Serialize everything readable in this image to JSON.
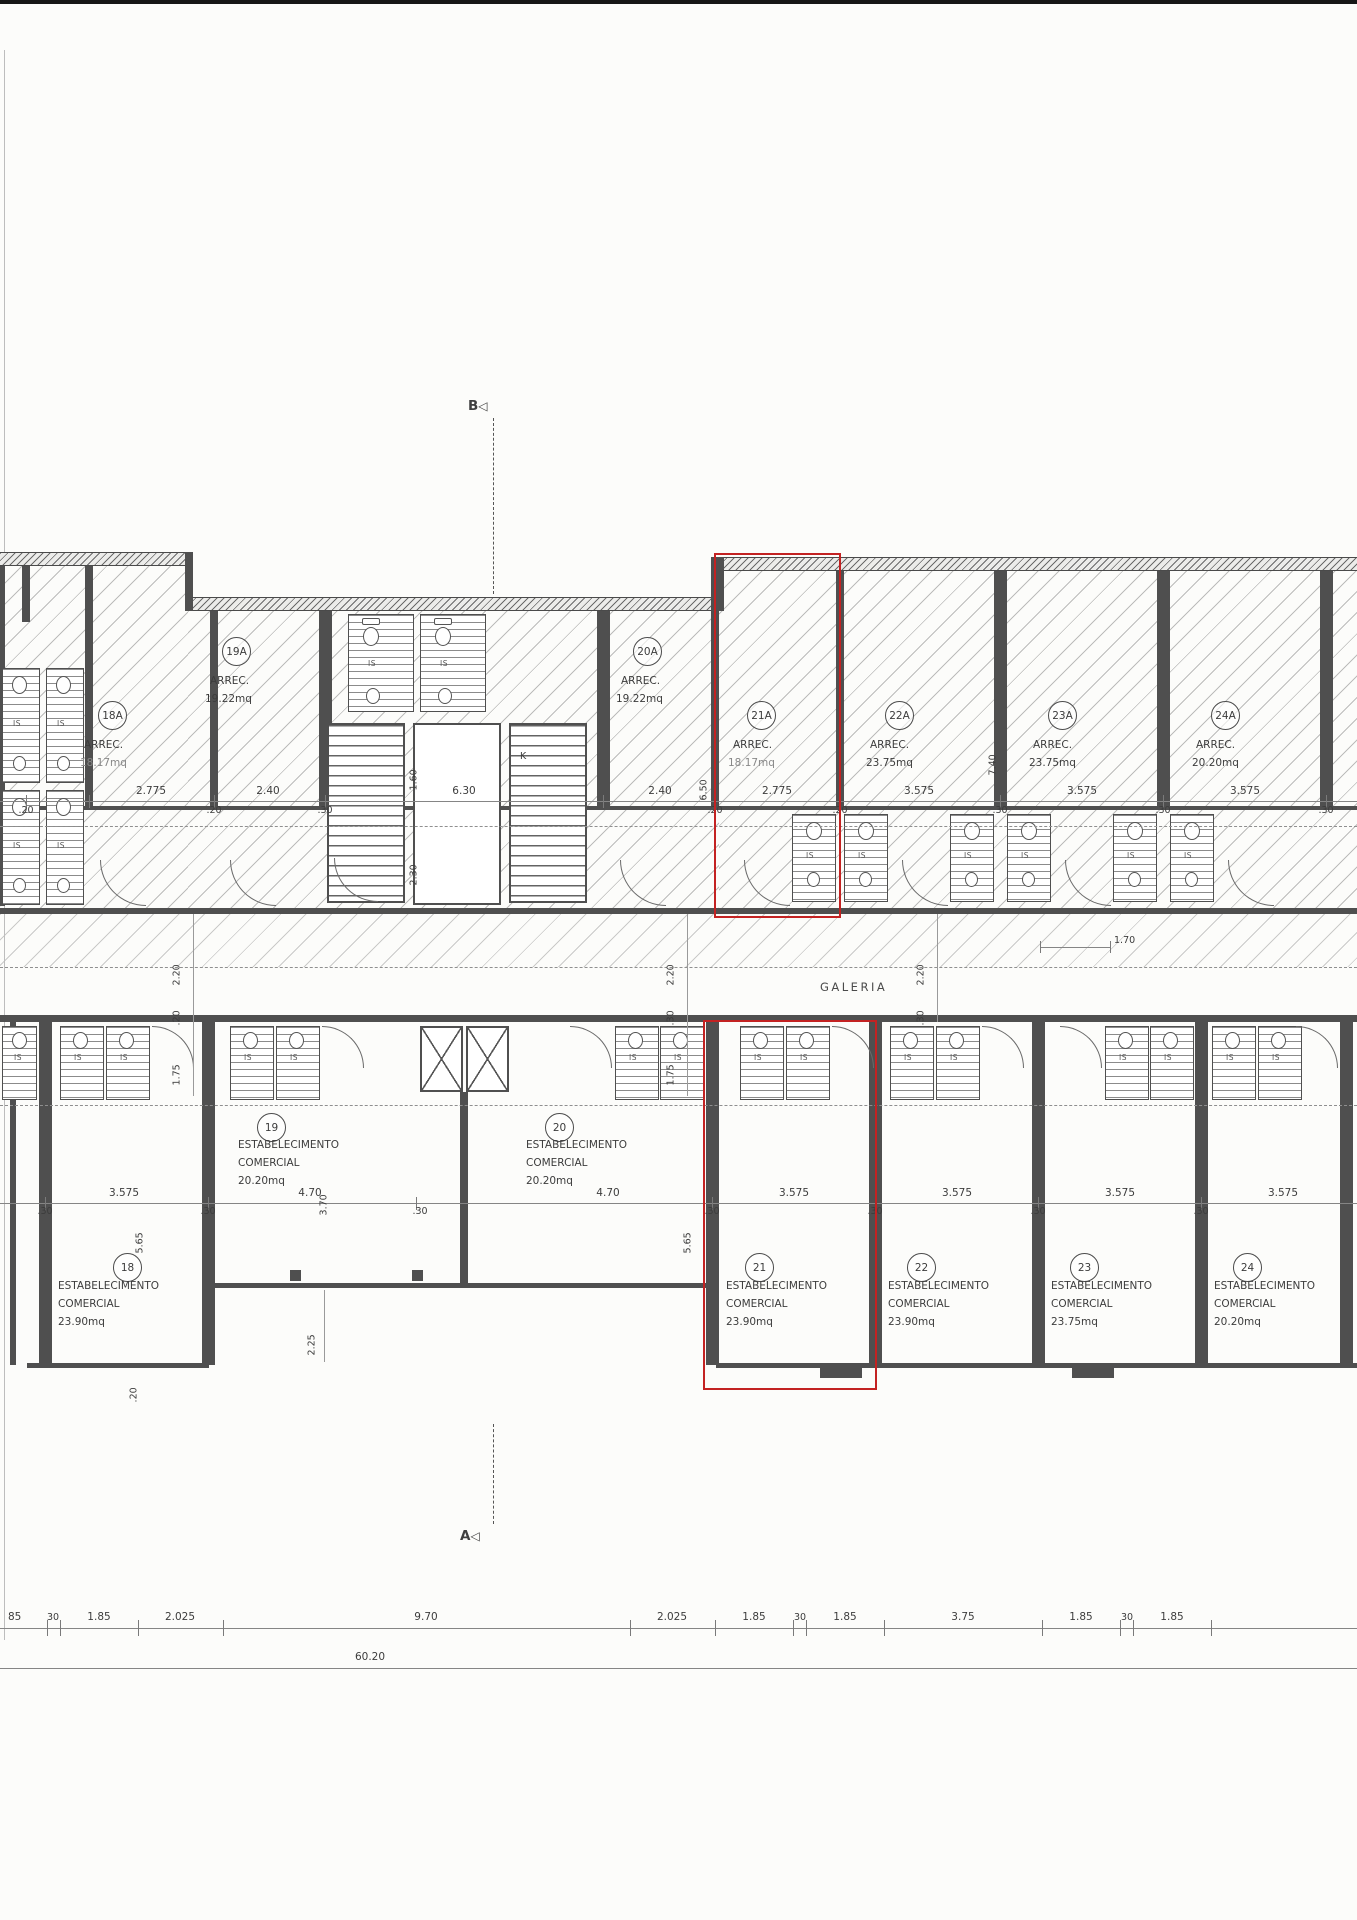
{
  "labels": {
    "arrec": "ARREC.",
    "estab1": "ESTABELECIMENTO",
    "estab2": "COMERCIAL",
    "galeria": "GALERIA",
    "is": "IS",
    "k": "K"
  },
  "markers": {
    "b": "B",
    "a": "A"
  },
  "colors": {
    "highlight": "#c32222",
    "wall": "#4f4f4f",
    "paper": "#fcfcfa"
  },
  "units_top": [
    {
      "id": "18A",
      "area": "18.17mq"
    },
    {
      "id": "19A",
      "area": "19.22mq"
    },
    {
      "id": "20A",
      "area": "19.22mq"
    },
    {
      "id": "21A",
      "area": "18.17mq",
      "highlighted": true
    },
    {
      "id": "22A",
      "area": "23.75mq"
    },
    {
      "id": "23A",
      "area": "23.75mq"
    },
    {
      "id": "24A",
      "area": "20.20mq"
    }
  ],
  "units_bottom": [
    {
      "id": "18",
      "area": "23.90mq"
    },
    {
      "id": "19",
      "area": "20.20mq"
    },
    {
      "id": "20",
      "area": "20.20mq"
    },
    {
      "id": "21",
      "area": "23.90mq",
      "highlighted": true
    },
    {
      "id": "22",
      "area": "23.90mq"
    },
    {
      "id": "23",
      "area": "23.75mq"
    },
    {
      "id": "24",
      "area": "20.20mq"
    }
  ],
  "dims": {
    "top_above": [
      "2.775",
      "2.40",
      "6.30",
      "2.40",
      "2.775",
      "3.575",
      "3.575",
      "3.575"
    ],
    "top_below": [
      ".20",
      ".20",
      ".30",
      ".20",
      ".20",
      ".30",
      ".30",
      ".30"
    ],
    "top_vertical": [
      "6.50",
      "7.40"
    ],
    "stair_vertical": [
      "1.60",
      "2.30"
    ],
    "galeria_chain_left": [
      "2.20",
      ".20",
      "1.75"
    ],
    "galeria_chain_mid": [
      "2.20",
      ".30",
      "1.75"
    ],
    "galeria_chain_right": [
      "2.20",
      ".30"
    ],
    "right_small": "1.70",
    "mid_above": [
      "3.575",
      "4.70",
      "4.70",
      "3.575",
      "3.575",
      "3.575",
      "3.575"
    ],
    "mid_below": [
      ".30",
      ".30",
      ".30",
      ".30",
      ".30",
      ".30",
      ".30"
    ],
    "mid_vertical": [
      "5.65",
      "3.70",
      "5.65",
      "2.25",
      ".20"
    ],
    "bottom_row": [
      "85",
      "30",
      "1.85",
      "2.025",
      "9.70",
      "2.025",
      "1.85",
      "30",
      "1.85",
      "3.75",
      "1.85",
      "30",
      "1.85"
    ],
    "total": "60.20"
  }
}
